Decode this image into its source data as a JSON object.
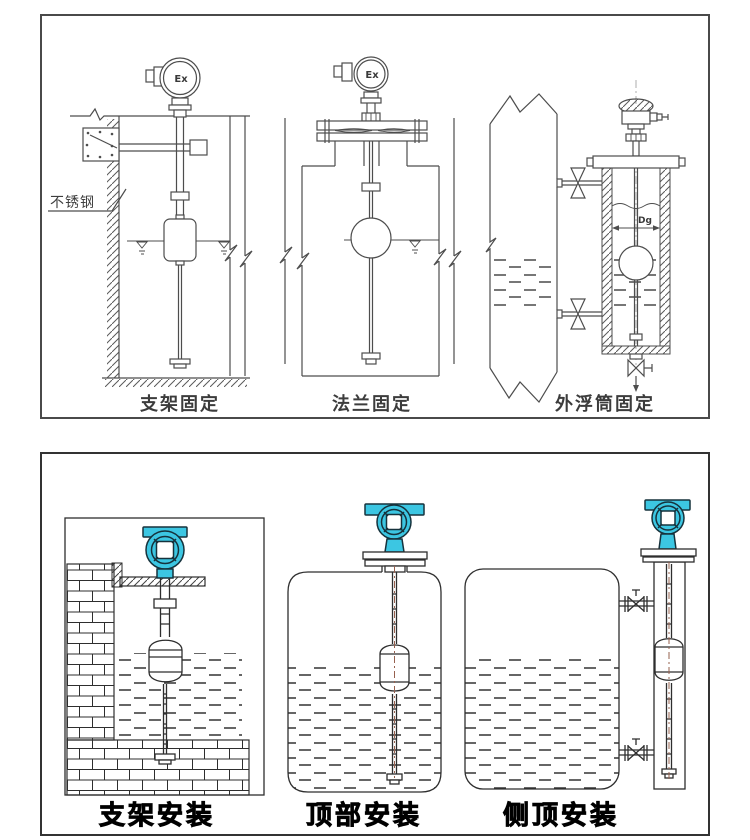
{
  "page": {
    "background": "#ffffff"
  },
  "colors": {
    "top_line": "#4d4d4d",
    "bottom_line": "#2e2e2e",
    "transmitter_cyan": "#3cc6e2",
    "rod_centerline": "#96604e"
  },
  "top_panel": {
    "figures": [
      {
        "caption": "支架固定",
        "wall_label": "不锈钢",
        "head_label": "Ex"
      },
      {
        "caption": "法兰固定",
        "head_label": "Ex"
      },
      {
        "caption": "外浮筒固定",
        "dimension_label": "Dg"
      }
    ]
  },
  "bottom_panel": {
    "figures": [
      {
        "caption": "支架安装"
      },
      {
        "caption": "顶部安装"
      },
      {
        "caption": "侧顶安装"
      }
    ]
  }
}
